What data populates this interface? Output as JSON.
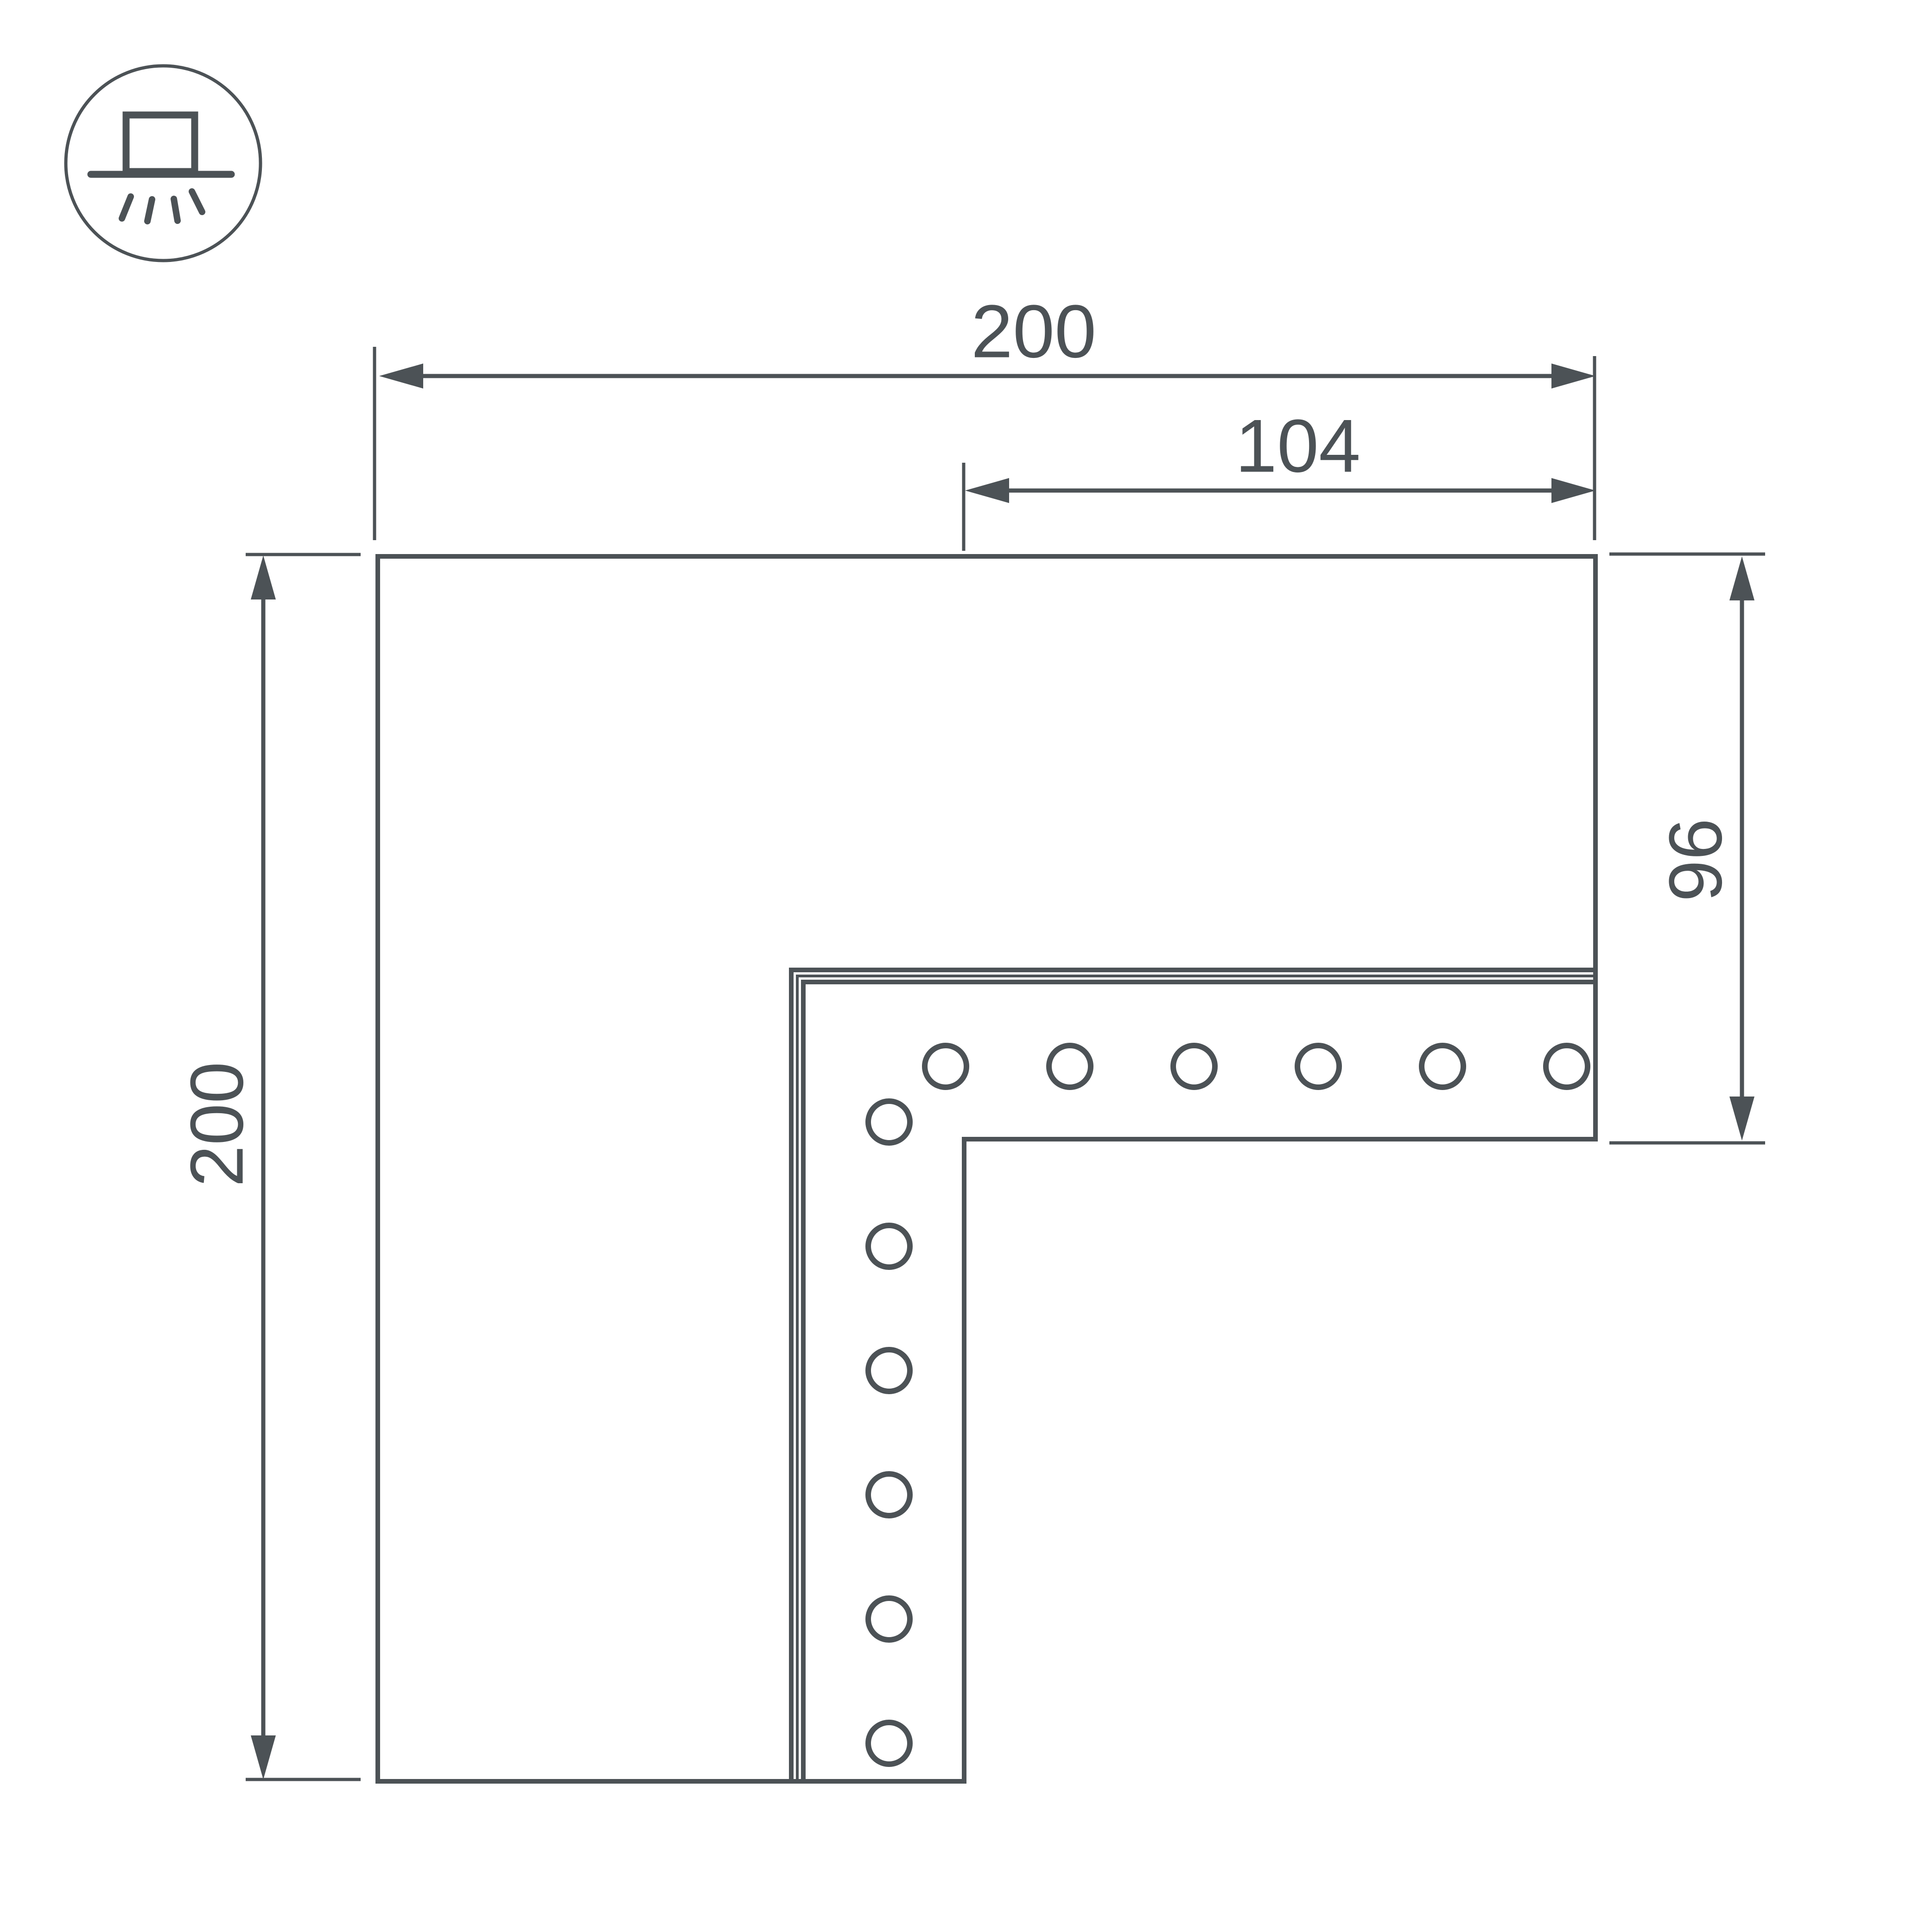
{
  "diagram": {
    "type": "technical-drawing",
    "accent_color": "#4c5256",
    "background_color": "#ffffff",
    "icon": {
      "name": "recessed-downlight-icon"
    },
    "dimensions": {
      "top_width": "200",
      "inner_width": "104",
      "left_height": "200",
      "right_height": "96"
    },
    "part": {
      "name": "l-shaped-corner-profile-connector",
      "holes_horizontal_count": "6",
      "holes_vertical_count": "6"
    }
  }
}
